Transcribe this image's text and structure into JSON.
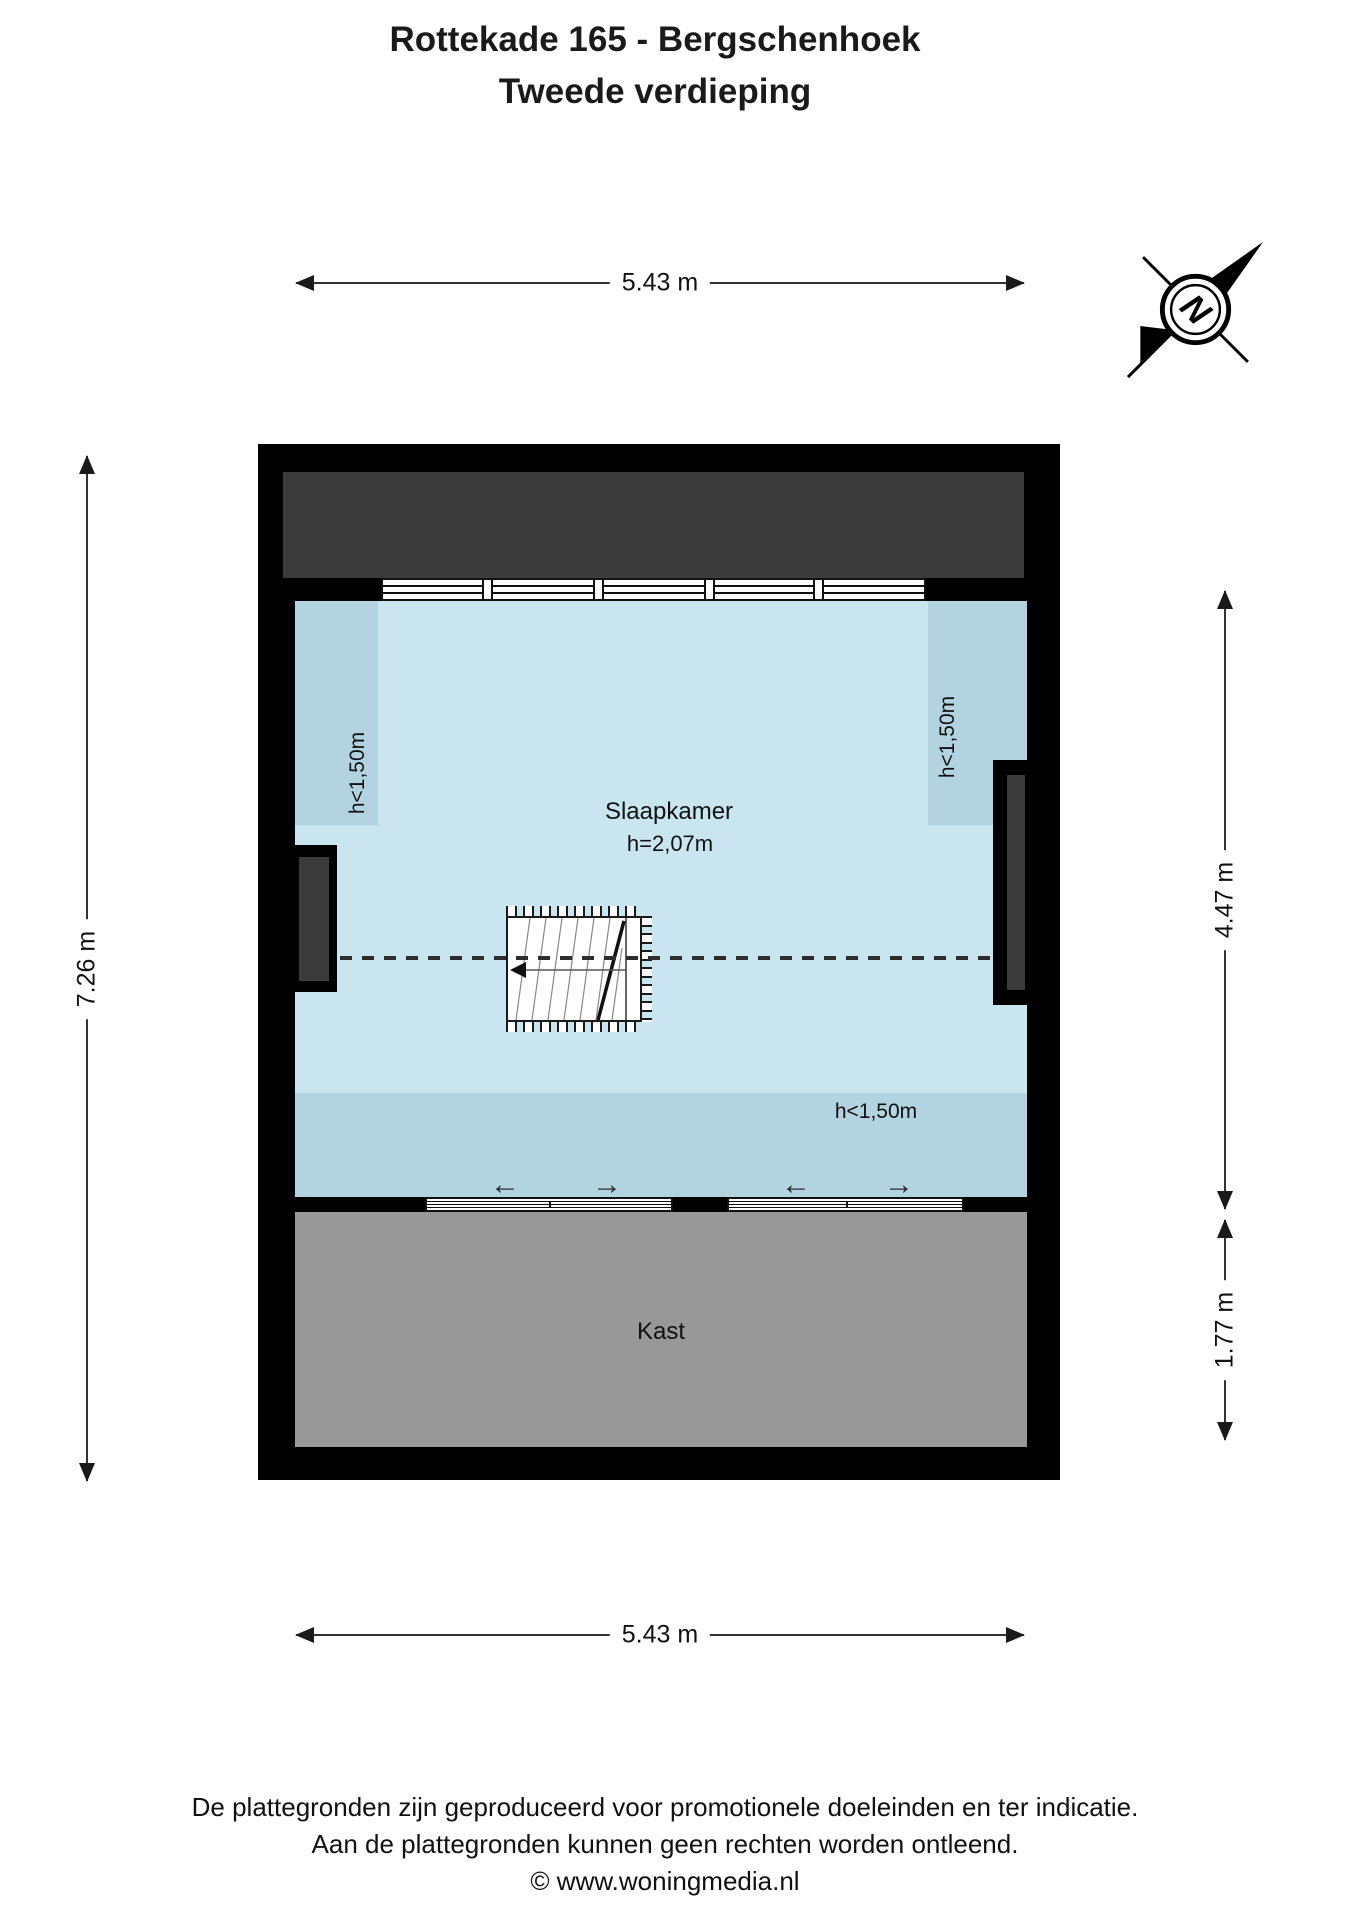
{
  "title": {
    "line1": "Rottekade 165 - Bergschenhoek",
    "line2": "Tweede verdieping"
  },
  "compass": {
    "label": "N"
  },
  "dimensions": {
    "top": "5.43 m",
    "bottom": "5.43 m",
    "left": "7.26 m",
    "right_upper": "4.47 m",
    "right_lower": "1.77 m"
  },
  "rooms": {
    "slaapkamer": {
      "name": "Slaapkamer",
      "height": "h=2,07m"
    },
    "kast": {
      "name": "Kast"
    }
  },
  "height_zones": {
    "left": "h<1,50m",
    "right": "h<1,50m",
    "bottom": "h<1,50m"
  },
  "slide_arrows": [
    "←",
    "→",
    "←",
    "→"
  ],
  "footer": {
    "line1": "De plattegronden zijn geproduceerd voor promotionele doeleinden en ter indicatie.",
    "line2": "Aan de plattegronden kunnen geen rechten worden ontleend.",
    "line3": "© www.woningmedia.nl"
  },
  "colors": {
    "room_blue": "#c9e6f0",
    "zone_blue": "#b2d3e0",
    "roof_dark": "#3b3b3b",
    "kast_gray": "#989898",
    "wall_black": "#000000",
    "dim_line": "#333333"
  }
}
